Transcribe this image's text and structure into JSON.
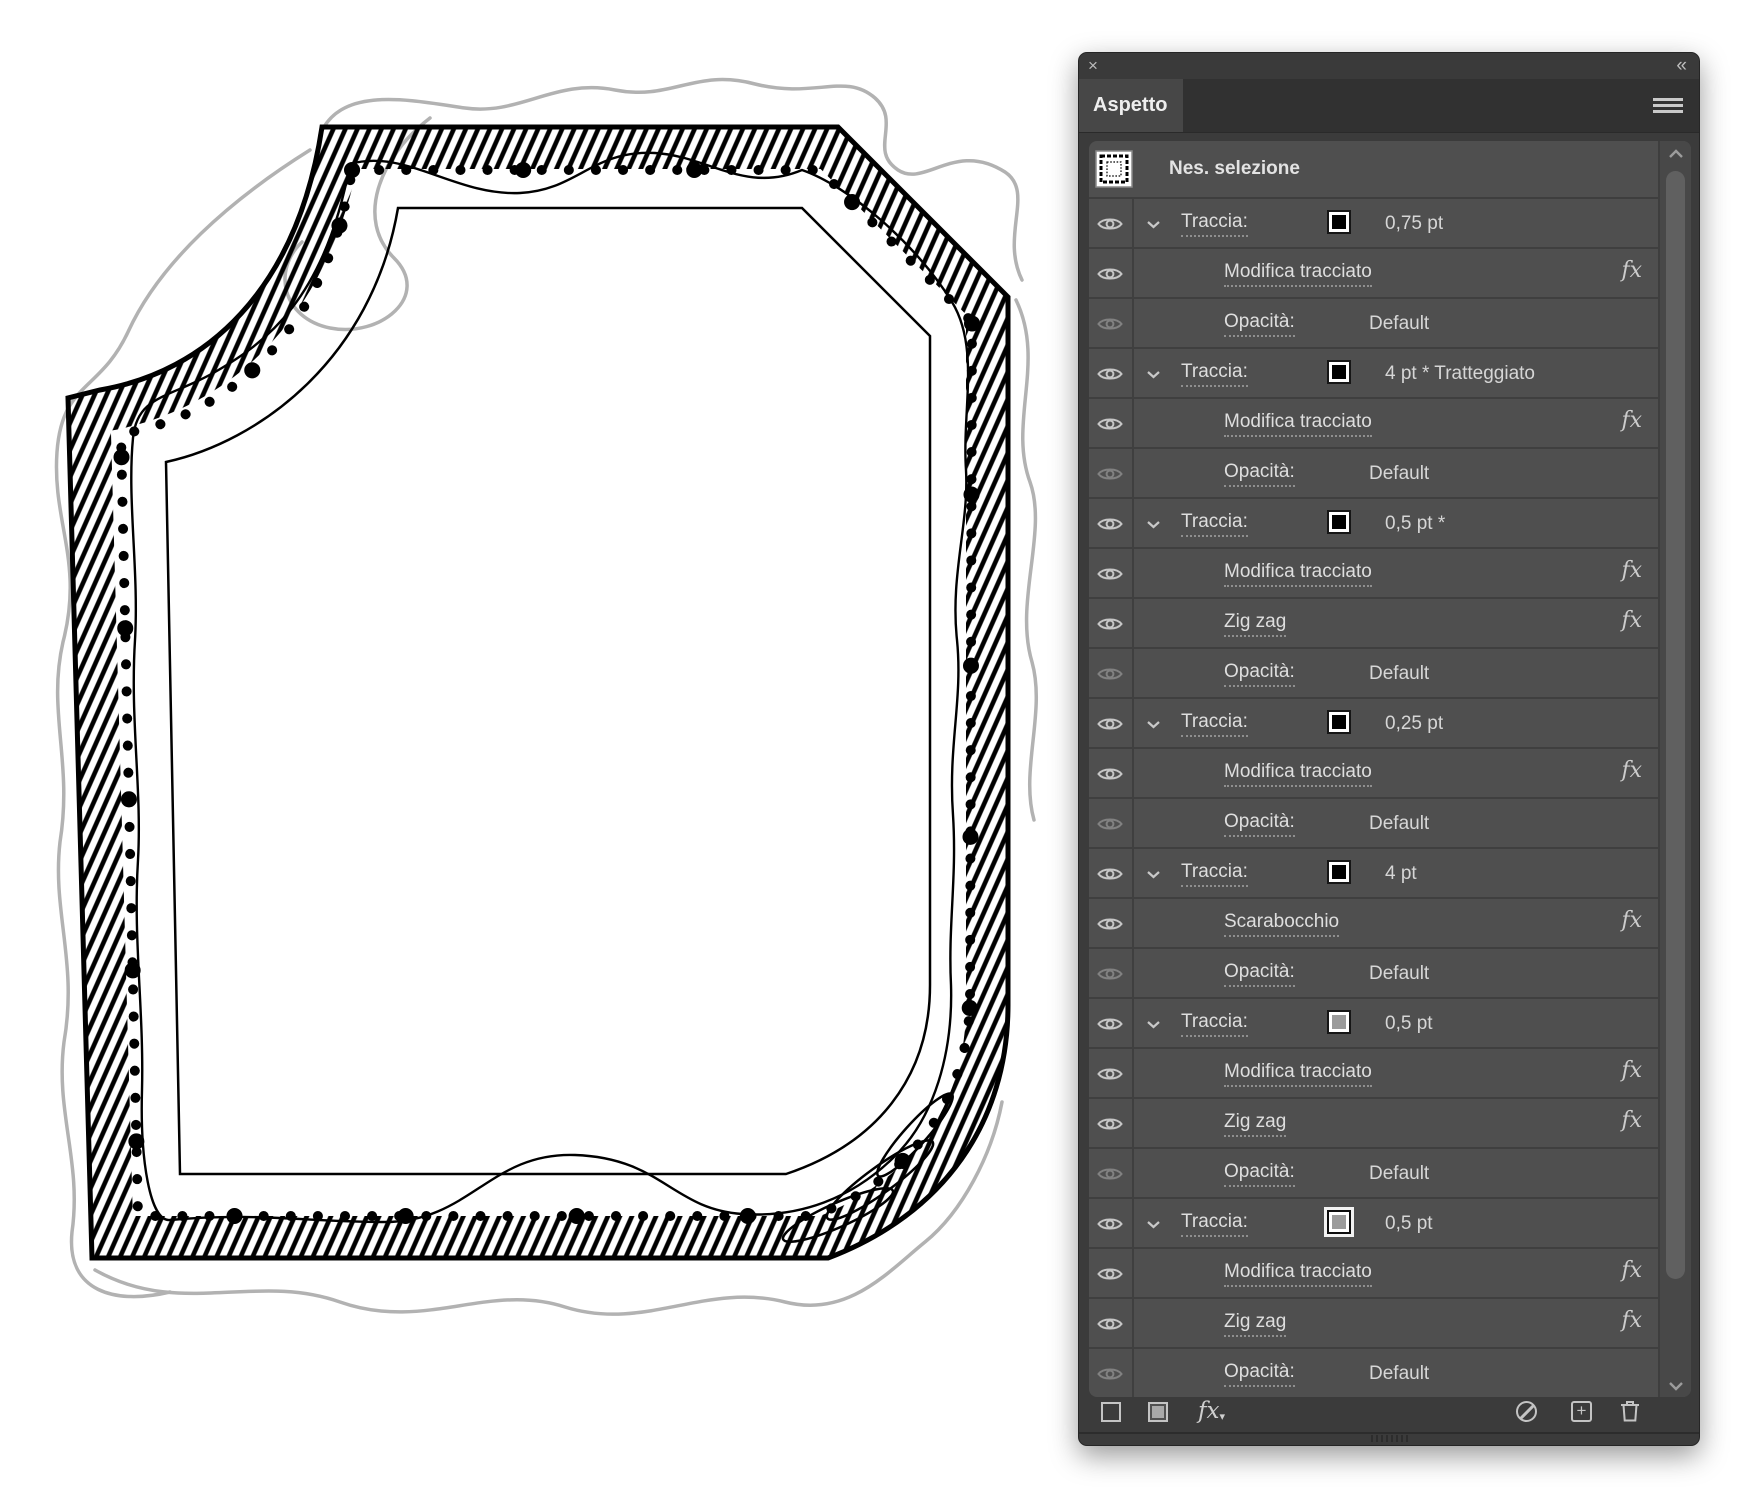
{
  "window": {
    "close_icon": "×",
    "collapse_icon": "«"
  },
  "panel": {
    "tab_label": "Aspetto",
    "menu_icon": "hamburger-menu",
    "header": {
      "selection_label": "Nes. selezione",
      "thumbnail_icon": "frame-preview"
    },
    "fx_glyph": "fx",
    "rows": [
      {
        "kind": "stroke",
        "label": "Traccia:",
        "value": "0,75 pt",
        "swatch": "#000000",
        "eye": "on"
      },
      {
        "kind": "effect",
        "label": "Modifica tracciato",
        "eye": "on"
      },
      {
        "kind": "opacity",
        "label": "Opacità:",
        "value": "Default",
        "eye": "dim"
      },
      {
        "kind": "stroke",
        "label": "Traccia:",
        "value": "4 pt * Tratteggiato",
        "swatch": "#000000",
        "eye": "on"
      },
      {
        "kind": "effect",
        "label": "Modifica tracciato",
        "eye": "on"
      },
      {
        "kind": "opacity",
        "label": "Opacità:",
        "value": "Default",
        "eye": "dim"
      },
      {
        "kind": "stroke",
        "label": "Traccia:",
        "value": "0,5 pt *",
        "swatch": "#000000",
        "eye": "on"
      },
      {
        "kind": "effect",
        "label": "Modifica tracciato",
        "eye": "on"
      },
      {
        "kind": "effect",
        "label": "Zig zag",
        "eye": "on"
      },
      {
        "kind": "opacity",
        "label": "Opacità:",
        "value": "Default",
        "eye": "dim"
      },
      {
        "kind": "stroke",
        "label": "Traccia:",
        "value": "0,25 pt",
        "swatch": "#000000",
        "eye": "on"
      },
      {
        "kind": "effect",
        "label": "Modifica tracciato",
        "eye": "on"
      },
      {
        "kind": "opacity",
        "label": "Opacità:",
        "value": "Default",
        "eye": "dim"
      },
      {
        "kind": "stroke",
        "label": "Traccia:",
        "value": "4 pt",
        "swatch": "#000000",
        "eye": "on"
      },
      {
        "kind": "effect",
        "label": "Scarabocchio",
        "eye": "on"
      },
      {
        "kind": "opacity",
        "label": "Opacità:",
        "value": "Default",
        "eye": "dim"
      },
      {
        "kind": "stroke",
        "label": "Traccia:",
        "value": "0,5 pt",
        "swatch": "#9b9b9b",
        "eye": "on"
      },
      {
        "kind": "effect",
        "label": "Modifica tracciato",
        "eye": "on"
      },
      {
        "kind": "effect",
        "label": "Zig zag",
        "eye": "on"
      },
      {
        "kind": "opacity",
        "label": "Opacità:",
        "value": "Default",
        "eye": "dim"
      },
      {
        "kind": "stroke",
        "label": "Traccia:",
        "value": "0,5 pt",
        "swatch": "#9b9b9b",
        "eye": "on",
        "selected": true
      },
      {
        "kind": "effect",
        "label": "Modifica tracciato",
        "eye": "on"
      },
      {
        "kind": "effect",
        "label": "Zig zag",
        "eye": "on"
      },
      {
        "kind": "opacity",
        "label": "Opacità:",
        "value": "Default",
        "eye": "dim"
      }
    ],
    "footer": {
      "new_stroke_icon": "square-outline",
      "new_fill_icon": "square-filled",
      "fx_menu_label": "fx",
      "clear_icon": "no-symbol",
      "duplicate_icon": "plus-box",
      "delete_icon": "trash"
    }
  },
  "artwork": {
    "description": "decorative sketched frame with hatched border, dotted line, wavy line and pencil scribbles",
    "ink_color": "#000000",
    "pencil_color": "#b2b2b2",
    "canvas_color": "#ffffff"
  }
}
